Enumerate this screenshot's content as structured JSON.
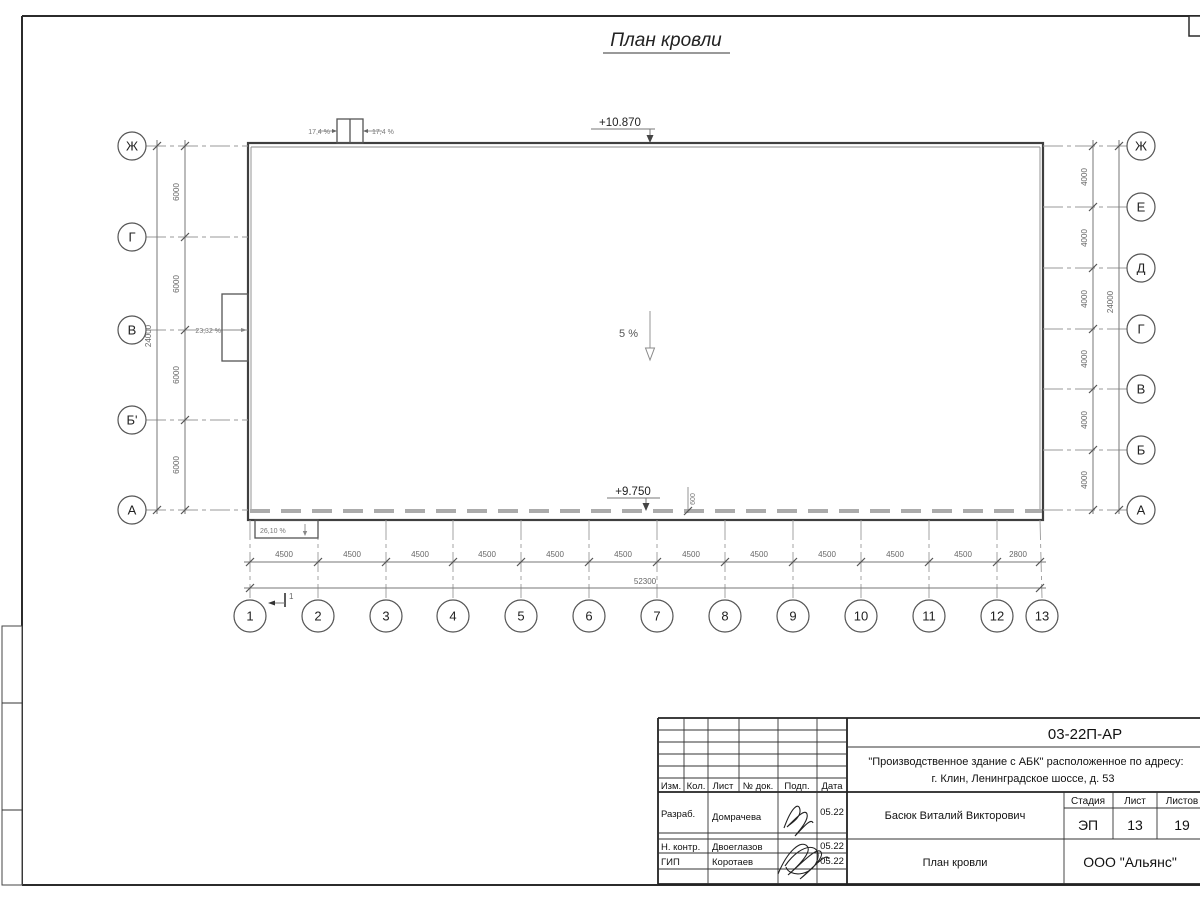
{
  "page": {
    "title": "План кровли"
  },
  "plan": {
    "elevation_top": "+10.870",
    "elevation_bottom": "+9.750",
    "slope_center": "5 %",
    "slope_left": "23,32 %",
    "slope_canopy": "26,10 %",
    "skylight_slope_left": "17,4 %",
    "skylight_slope_right": "17,4 %",
    "parapet_offset": "600",
    "section_mark": "1"
  },
  "axes": {
    "left": [
      "Ж",
      "Г",
      "В",
      "Б'",
      "А"
    ],
    "right": [
      "Ж",
      "Е",
      "Д",
      "Г",
      "В",
      "Б",
      "А"
    ],
    "bottom": [
      "1",
      "2",
      "3",
      "4",
      "5",
      "6",
      "7",
      "8",
      "9",
      "10",
      "11",
      "12",
      "13"
    ]
  },
  "dims": {
    "left_segments": [
      "6000",
      "6000",
      "6000",
      "6000"
    ],
    "left_total": "24000",
    "right_segments": [
      "4000",
      "4000",
      "4000",
      "4000",
      "4000",
      "4000"
    ],
    "right_total": "24000",
    "bottom_segments": [
      "4500",
      "4500",
      "4500",
      "4500",
      "4500",
      "4500",
      "4500",
      "4500",
      "4500",
      "4500",
      "4500",
      "2800"
    ],
    "bottom_total": "52300"
  },
  "title_block": {
    "doc_number": "03-22П-АР",
    "project_line1": "\"Производственное здание с АБК\" расположенное по адресу:",
    "project_line2": "г. Клин, Ленинградское шоссе, д. 53",
    "header_cols": [
      "Изм.",
      "Кол.",
      "Лист",
      "№ док.",
      "Подп.",
      "Дата"
    ],
    "rows": [
      {
        "role": "Разраб.",
        "name": "Домрачева",
        "date": "05.22"
      },
      {
        "role": "Н. контр.",
        "name": "Двоеглазов",
        "date": "05.22"
      },
      {
        "role": "ГИП",
        "name": "Коротаев",
        "date": "05.22"
      }
    ],
    "approver": "Басюк Виталий Викторович",
    "sheet_title": "План кровли",
    "stage_label": "Стадия",
    "sheet_label": "Лист",
    "sheets_label": "Листов",
    "stage": "ЭП",
    "sheet": "13",
    "sheets": "19",
    "company": "ООО \"Альянс\""
  }
}
